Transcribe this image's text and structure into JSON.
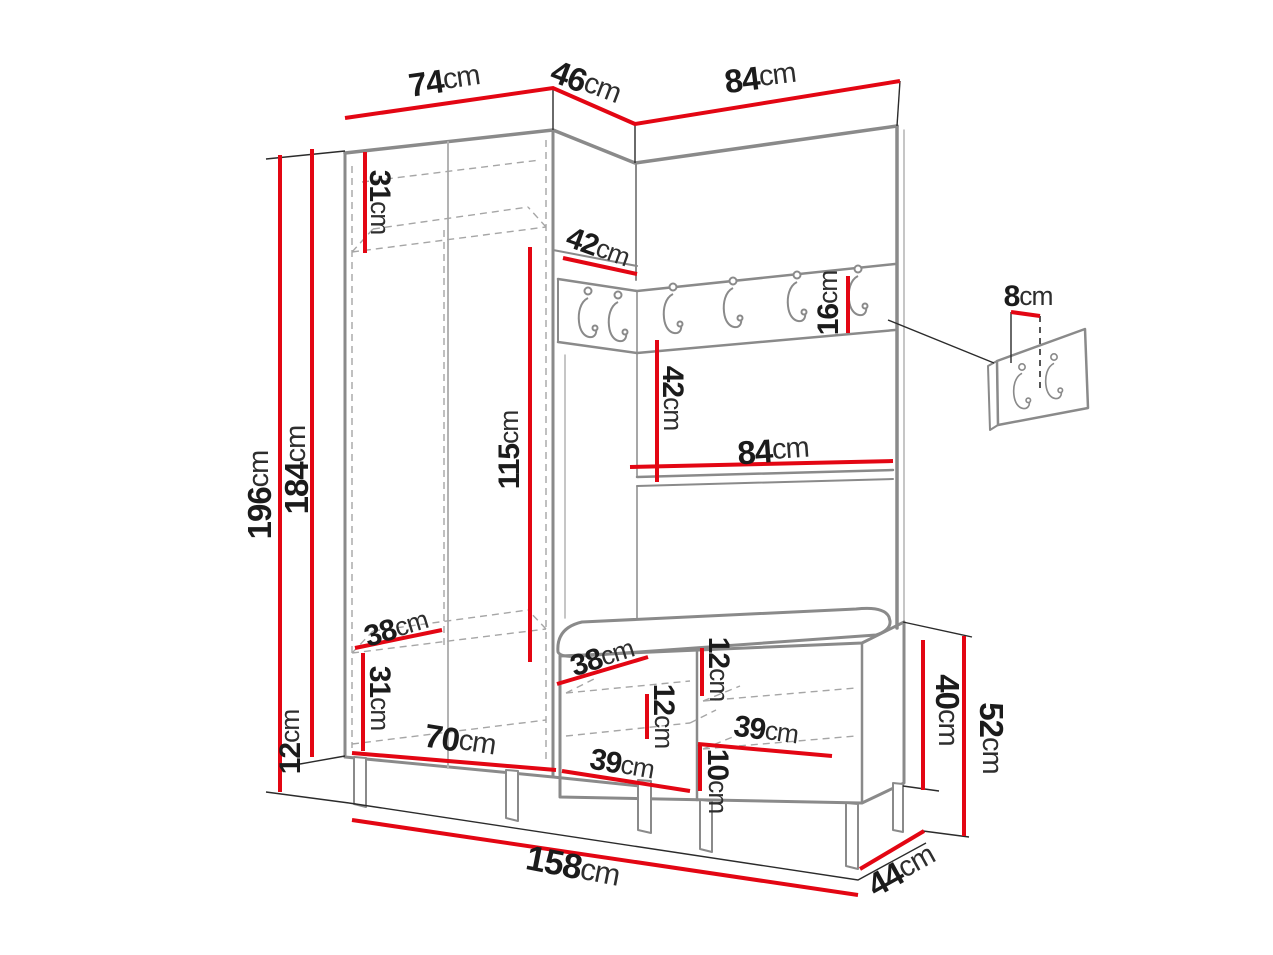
{
  "diagram": {
    "kind": "hallway-furniture-dimension-diagram",
    "unit": "cm",
    "colors": {
      "dimension_line": "#e30613",
      "furniture_outline": "#8a8a8a",
      "label_text": "#1b1b1b",
      "background": "#ffffff"
    },
    "furniture": {
      "main_rail_hook_count": 6,
      "wall_panel_hook_count": 2
    }
  },
  "dims": {
    "top_width_left": {
      "value": "74",
      "unit": "cm"
    },
    "top_width_corner": {
      "value": "46",
      "unit": "cm"
    },
    "top_width_right": {
      "value": "84",
      "unit": "cm"
    },
    "total_height": {
      "value": "196",
      "unit": "cm"
    },
    "carcass_height": {
      "value": "184",
      "unit": "cm"
    },
    "leg_height": {
      "value": "12",
      "unit": "cm"
    },
    "top_shelf_height": {
      "value": "31",
      "unit": "cm"
    },
    "corner_top_depth": {
      "value": "42",
      "unit": "cm"
    },
    "hook_rail_height": {
      "value": "16",
      "unit": "cm"
    },
    "panel_opening_height": {
      "value": "42",
      "unit": "cm"
    },
    "panel_width": {
      "value": "84",
      "unit": "cm"
    },
    "hanging_height": {
      "value": "115",
      "unit": "cm"
    },
    "wardrobe_depth": {
      "value": "38",
      "unit": "cm"
    },
    "bottom_section_height": {
      "value": "31",
      "unit": "cm"
    },
    "wardrobe_inner_width": {
      "value": "70",
      "unit": "cm"
    },
    "bench_depth": {
      "value": "38",
      "unit": "cm"
    },
    "cushion_section_height": {
      "value": "12",
      "unit": "cm"
    },
    "bench_shelf_spacing": {
      "value": "12",
      "unit": "cm"
    },
    "bench_inner_width_right": {
      "value": "39",
      "unit": "cm"
    },
    "bench_inner_width_left": {
      "value": "39",
      "unit": "cm"
    },
    "bench_bottom_height": {
      "value": "10",
      "unit": "cm"
    },
    "bench_body_height": {
      "value": "40",
      "unit": "cm"
    },
    "bench_total_height": {
      "value": "52",
      "unit": "cm"
    },
    "total_width": {
      "value": "158",
      "unit": "cm"
    },
    "bench_total_depth": {
      "value": "44",
      "unit": "cm"
    },
    "wall_panel_hook_gap": {
      "value": "8",
      "unit": "cm"
    }
  }
}
